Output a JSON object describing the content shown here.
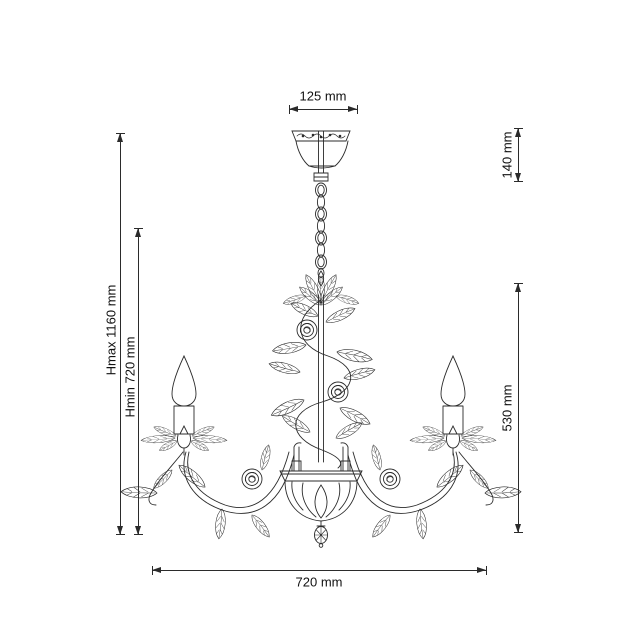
{
  "canvas": {
    "background": "#ffffff",
    "line_color": "#2b2b2b",
    "text_color": "#111111"
  },
  "figure": {
    "name": "chandelier-technical-drawing"
  },
  "dimensions": {
    "top_width": {
      "label": "125 mm"
    },
    "canopy_drop": {
      "label": "140 mm"
    },
    "height_max": {
      "label": "Hmax 1160 mm"
    },
    "height_min": {
      "label": "Hmin 720 mm"
    },
    "fixture_height": {
      "label": "530 mm"
    },
    "fixture_width": {
      "label": "720 mm"
    }
  }
}
